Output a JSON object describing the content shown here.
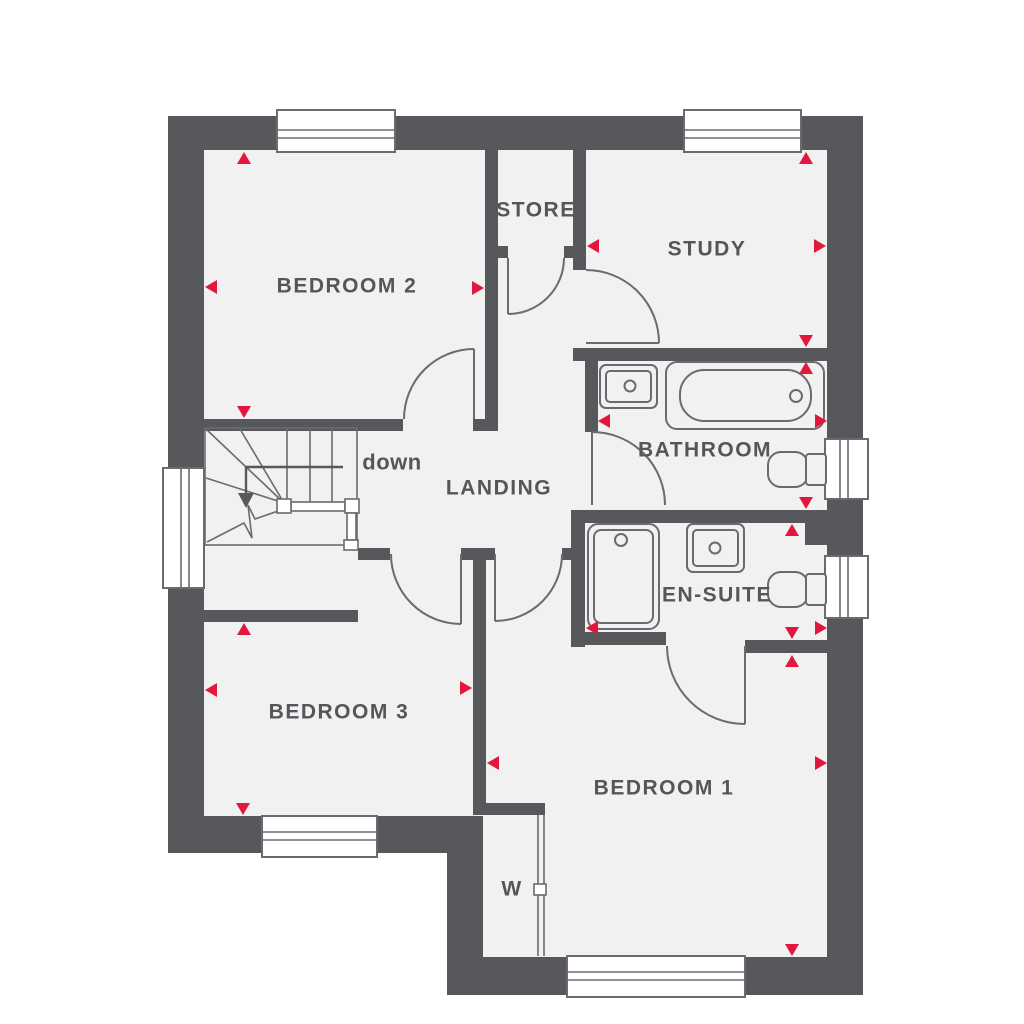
{
  "floorplan": {
    "rooms": {
      "bedroom2": {
        "label": "BEDROOM 2"
      },
      "store": {
        "label": "STORE"
      },
      "study": {
        "label": "STUDY"
      },
      "bathroom": {
        "label": "BATHROOM"
      },
      "landing": {
        "label": "LANDING"
      },
      "ensuite": {
        "label": "EN-SUITE"
      },
      "bedroom3": {
        "label": "BEDROOM 3"
      },
      "bedroom1": {
        "label": "BEDROOM 1"
      },
      "wardrobe": {
        "label": "W"
      }
    },
    "stairs": {
      "down_label": "down"
    },
    "colors": {
      "wall": "#57585b",
      "floor": "#f1f1f2",
      "line": "#6a6b6e",
      "text": "#55565a",
      "marker": "#e2173d",
      "background": "#ffffff"
    }
  }
}
